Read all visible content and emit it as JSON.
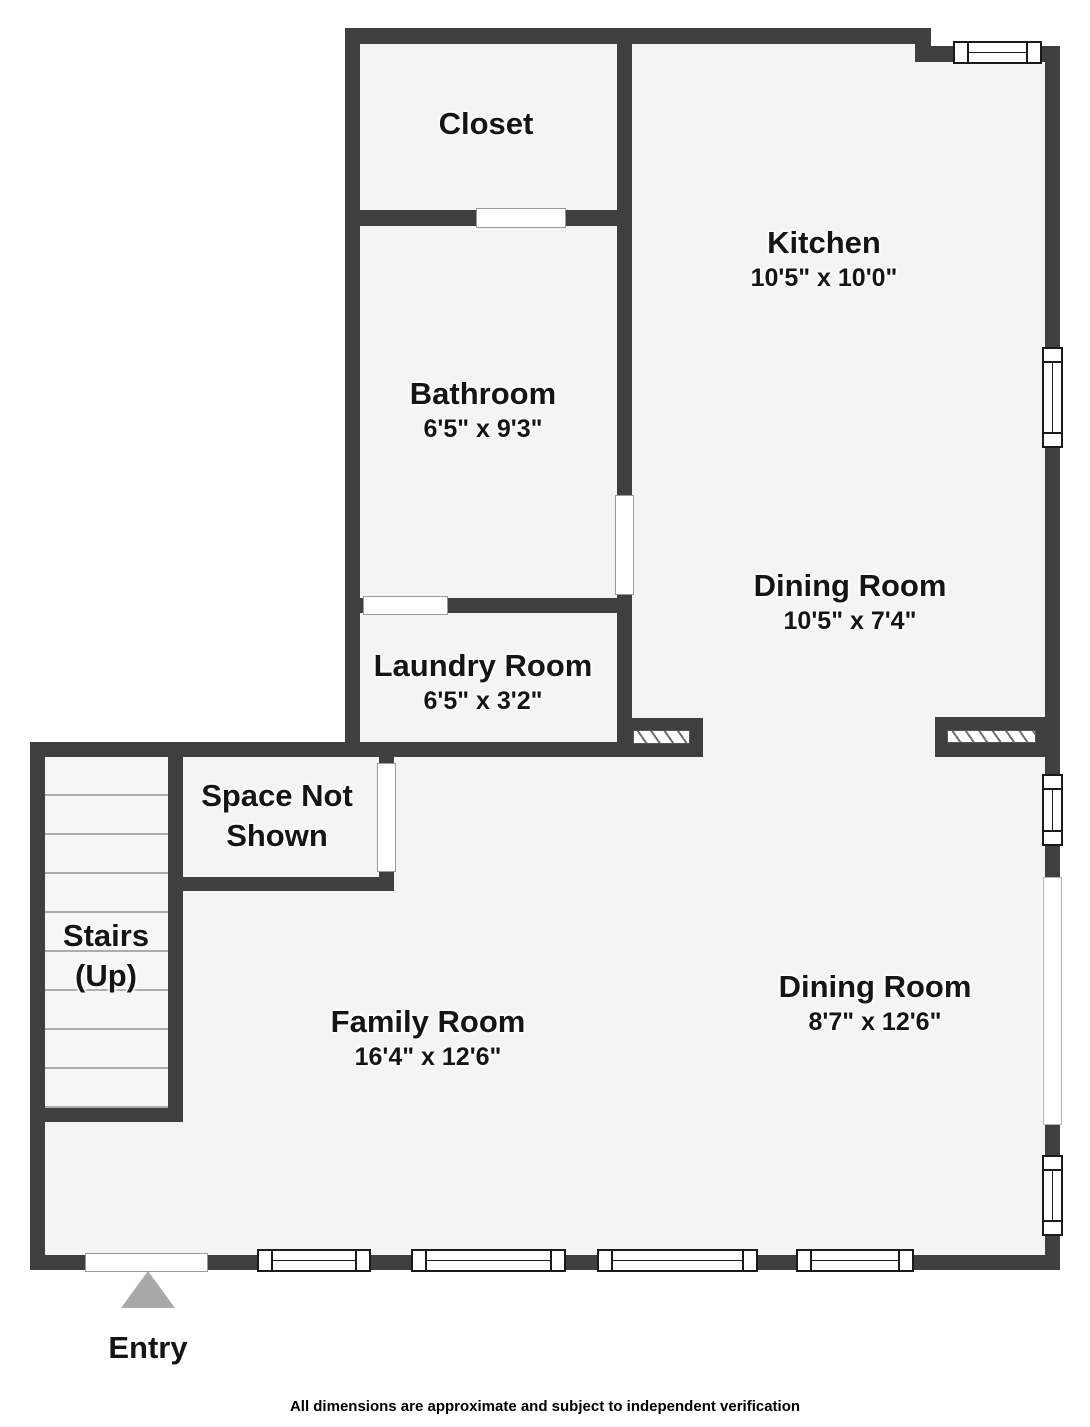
{
  "colors": {
    "wall": "#3F3F3F",
    "floor": "#F4F4F4",
    "tread_line": "#ABABAB",
    "entry_arrow": "#A9A9A9",
    "text": "#151515"
  },
  "rooms": [
    {
      "name": "Closet",
      "dimensions": ""
    },
    {
      "name": "Kitchen",
      "dimensions": "10'5\" x 10'0\""
    },
    {
      "name": "Bathroom",
      "dimensions": "6'5\" x 9'3\""
    },
    {
      "name": "Dining Room",
      "dimensions": "10'5\" x 7'4\""
    },
    {
      "name": "Laundry Room",
      "dimensions": "6'5\" x 3'2\""
    },
    {
      "name": "Space Not Shown",
      "dimensions": ""
    },
    {
      "name": "Stairs (Up)",
      "dimensions": ""
    },
    {
      "name": "Family Room",
      "dimensions": "16'4\" x 12'6\""
    },
    {
      "name": "Dining Room",
      "dimensions": "8'7\" x 12'6\""
    }
  ],
  "entry": {
    "label": "Entry"
  },
  "footer": {
    "disclaimer": "All dimensions are approximate and subject to independent verification"
  }
}
